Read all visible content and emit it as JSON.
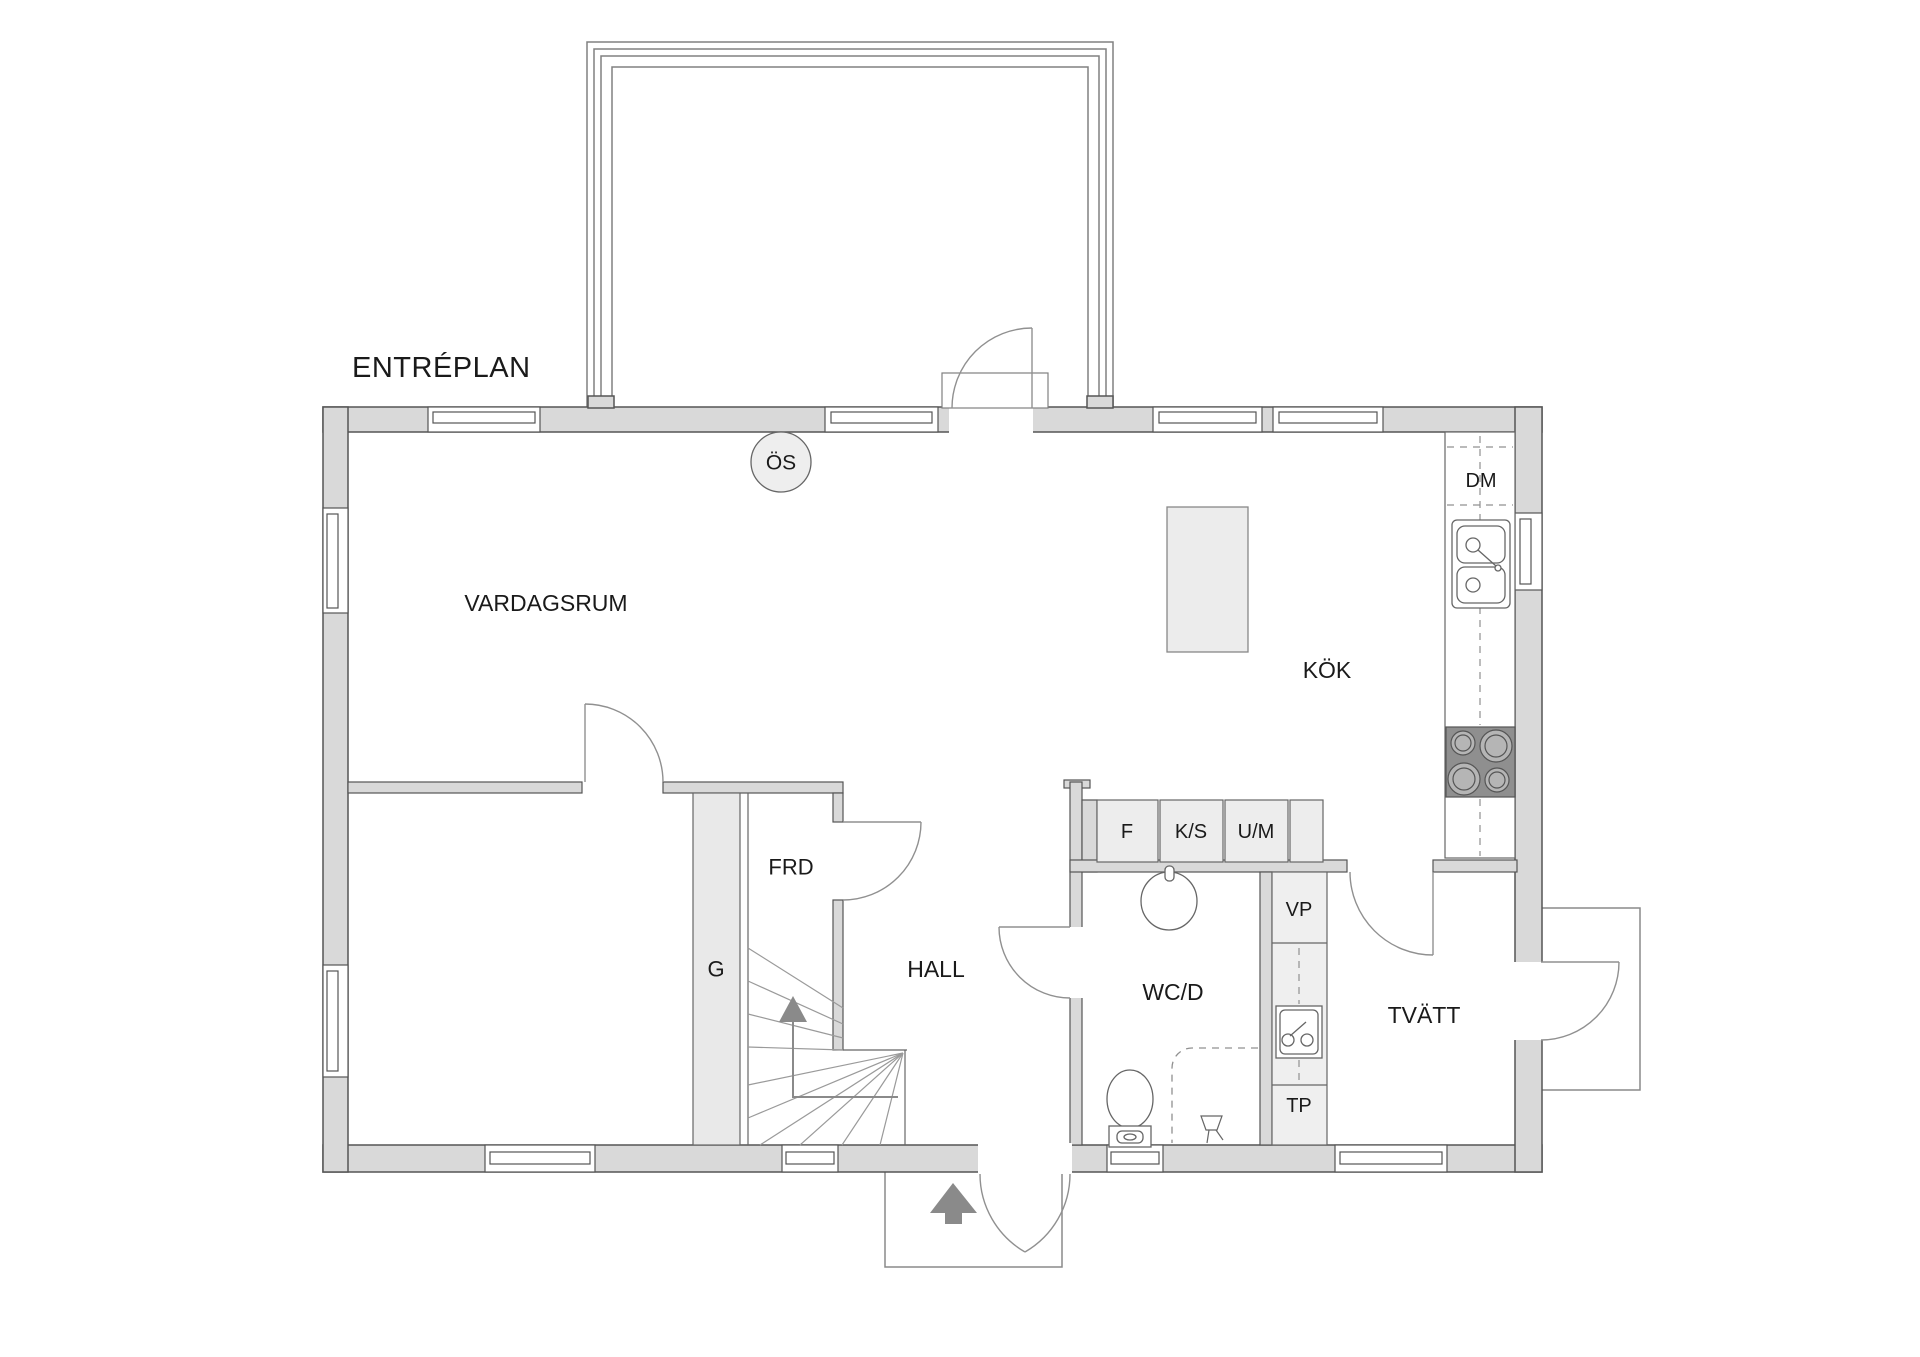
{
  "title": "ENTRÉPLAN",
  "rooms": {
    "living_room": "VARDAGSRUM",
    "kitchen": "KÖK",
    "hall": "HALL",
    "wc_shower": "WC/D",
    "laundry": "TVÄTT",
    "storage": "FRD",
    "wardrobe": "G"
  },
  "fixtures": {
    "fireplace": "ÖS",
    "dishwasher": "DM",
    "fridge": "F",
    "fridge_freezer": "K/S",
    "oven_microwave": "U/M",
    "heat_pump": "VP",
    "dryer": "TP"
  },
  "colors": {
    "wall": "#d9d9d9",
    "outline": "#555555",
    "fixture_fill": "#ededed",
    "stove": "#8f8f8f",
    "arrow": "#8a8a8a"
  }
}
